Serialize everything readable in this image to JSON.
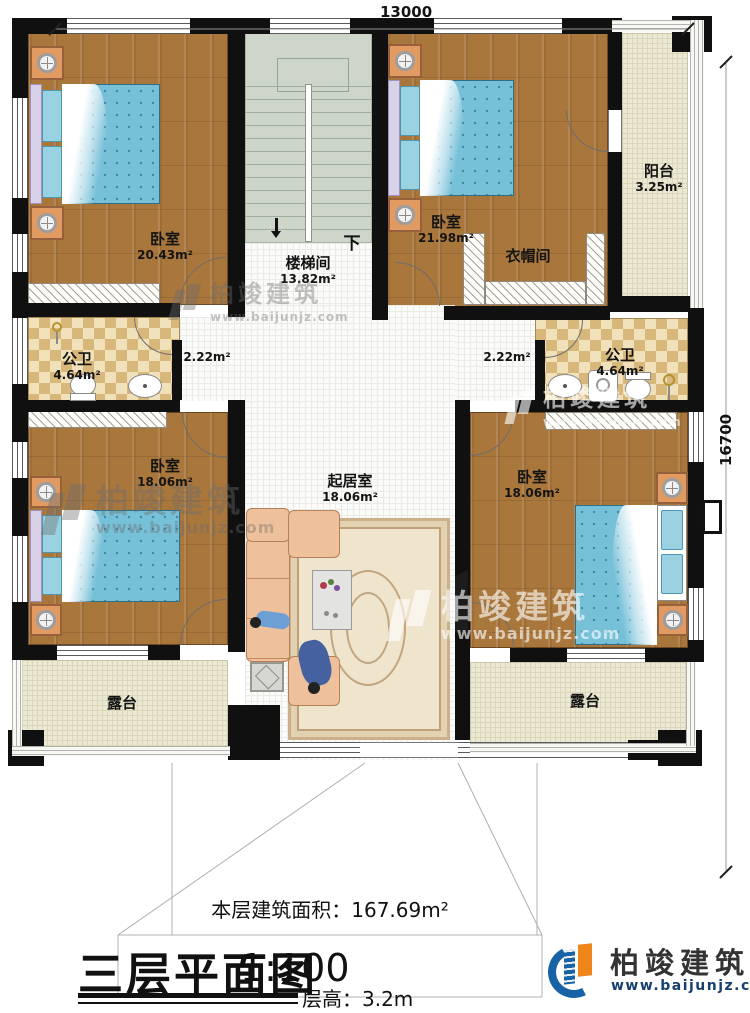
{
  "dims": {
    "top": "13000",
    "right": "16700"
  },
  "rooms": {
    "bedroom_tl": {
      "name": "卧室",
      "area": "20.43m²"
    },
    "bedroom_tr": {
      "name": "卧室",
      "area": "21.98m²"
    },
    "bedroom_ml": {
      "name": "卧室",
      "area": "18.06m²"
    },
    "bedroom_mr": {
      "name": "卧室",
      "area": "18.06m²"
    },
    "stairwell": {
      "name": "楼梯间",
      "area": "13.82m²",
      "down": "下"
    },
    "cloakroom": {
      "name": "衣帽间"
    },
    "balcony": {
      "name": "阳台",
      "area": "3.25m²"
    },
    "bath_left": {
      "name": "公卫",
      "area": "4.64m²"
    },
    "bath_right": {
      "name": "公卫",
      "area": "4.64m²"
    },
    "hall_left": {
      "area": "2.22m²"
    },
    "hall_right": {
      "area": "2.22m²"
    },
    "living": {
      "name": "起居室",
      "area": "18.06m²"
    },
    "terrace_left": {
      "name": "露台"
    },
    "terrace_right": {
      "name": "露台"
    }
  },
  "annotation": {
    "floor_area_label": "本层建筑面积：",
    "floor_area_value": "167.69m²"
  },
  "title_block": {
    "plan_title": "三层平面图",
    "scale": "1:100",
    "floor_height_label": "层高：",
    "floor_height_value": "3.2m"
  },
  "brand": {
    "name": "柏竣建筑",
    "website": "www.baijunjz.com"
  },
  "colors": {
    "wall": "#101010",
    "wood_floor": "#a9763c",
    "stair_floor": "#ced6ca",
    "terrace_floor": "#ebe8d3",
    "bath_tile": "#d8b77b",
    "mattress": "#76c0d8",
    "brand_blue": "#1763a6",
    "brand_orange": "#f08519"
  }
}
